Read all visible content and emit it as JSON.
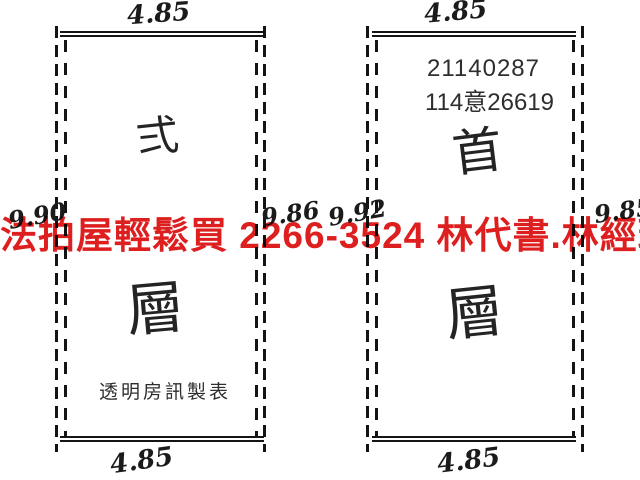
{
  "page": {
    "background_color": "#ffffff",
    "ink_color": "#141414"
  },
  "watermark": {
    "text": "法拍屋輕鬆買  2266-3524  林代書.林經理",
    "color": "#dd1f1f"
  },
  "left_unit": {
    "top_dimension": "4.85",
    "bottom_dimension": "4.85",
    "left_dimension": "9.90",
    "right_dimension": "9.86",
    "floor_char_top": "弍",
    "floor_char_bottom": "層",
    "maker_label": "透明房訊製表"
  },
  "right_unit": {
    "top_dimension": "4.85",
    "bottom_dimension": "4.85",
    "left_dimension": "9.92",
    "right_dimension": "9.85",
    "case_number_line1": "21140287",
    "case_number_line2": "114意26619",
    "floor_char_top": "首",
    "floor_char_bottom": "層"
  }
}
